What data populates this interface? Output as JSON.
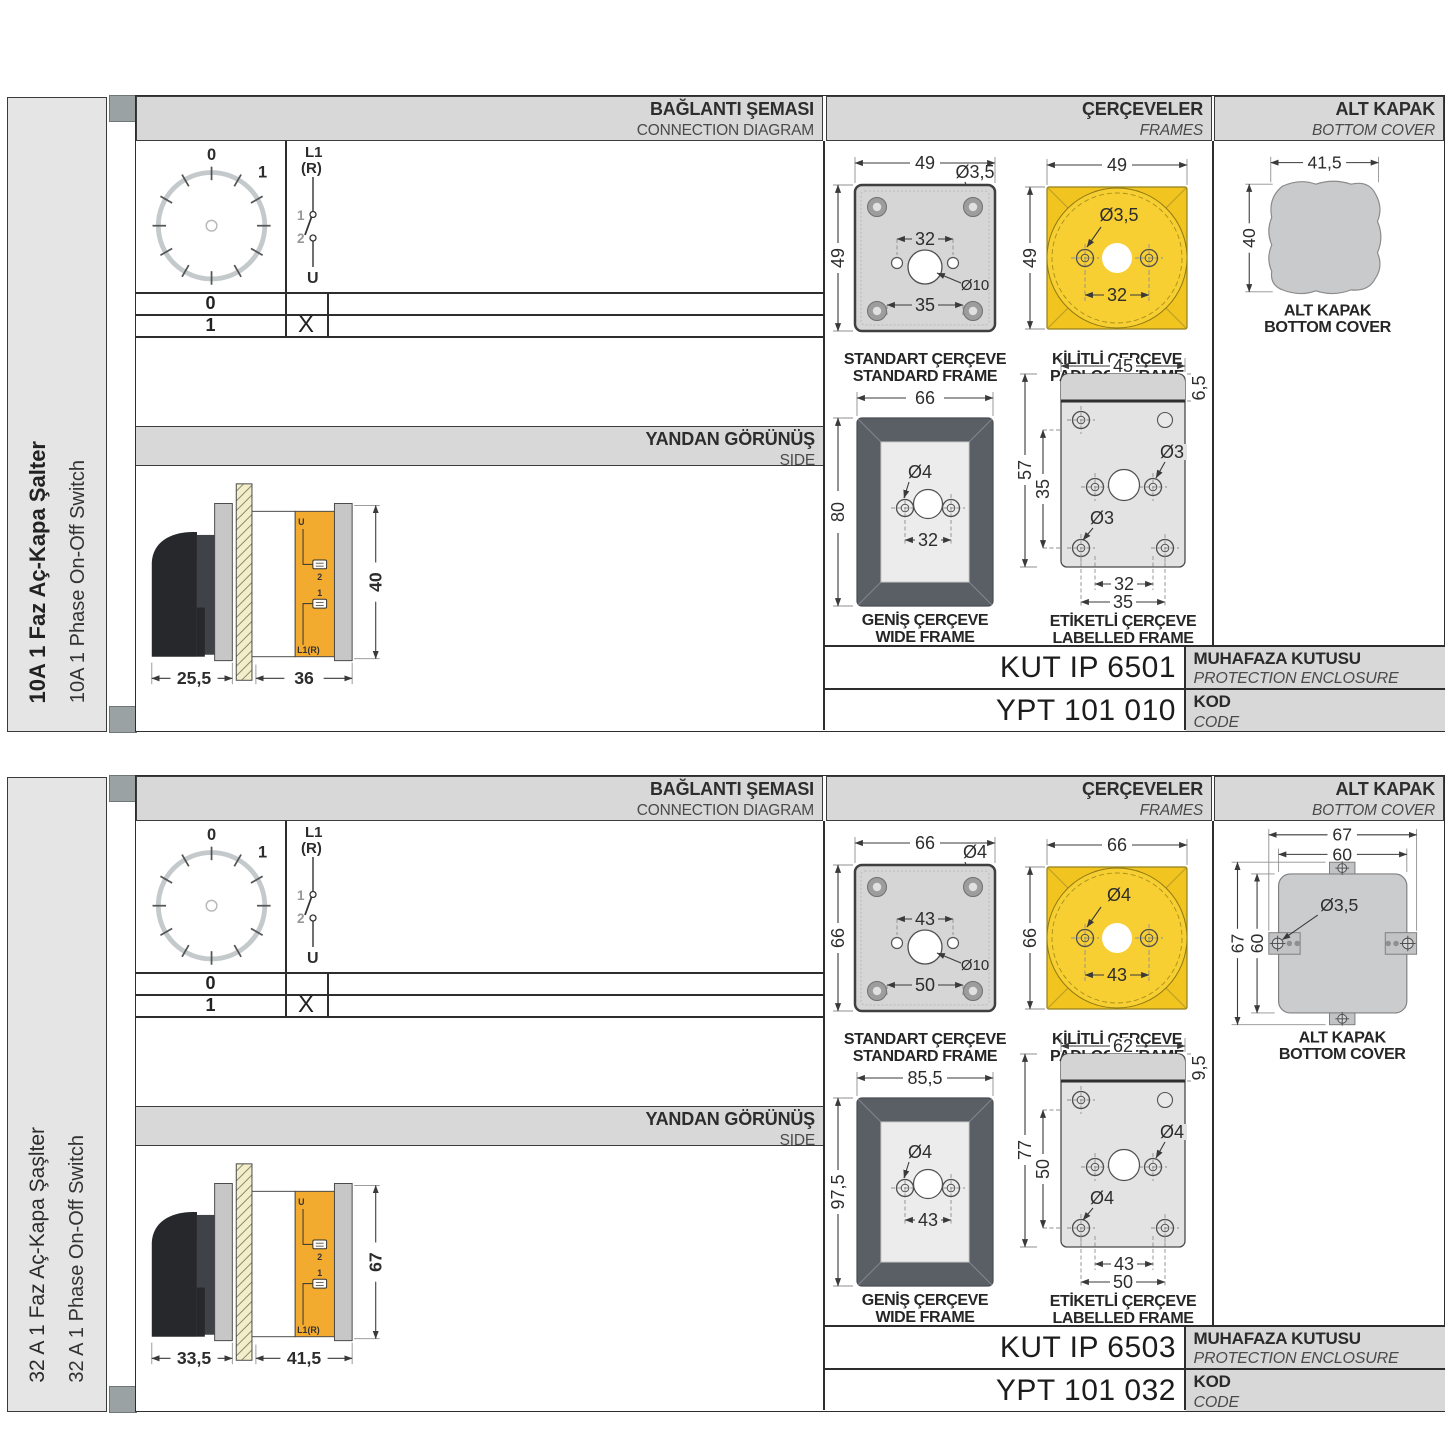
{
  "sections": [
    {
      "side_label_tr": "10A 1 Faz Aç-Kapa Şalter",
      "side_label_en": "10A 1 Phase On-Off Switch",
      "headers": {
        "connection_tr": "BAĞLANTI ŞEMASI",
        "connection_en": "CONNECTION DIAGRAM",
        "frames_tr": "ÇERÇEVELER",
        "frames_en": "FRAMES",
        "cover_tr": "ALT KAPAK",
        "cover_en": "BOTTOM COVER",
        "side_tr": "YANDAN GÖRÜNÜŞ",
        "side_en": "SIDE"
      },
      "connection": {
        "pos_top": "0",
        "pos_right": "1",
        "pole_top_1": "L1",
        "pole_top_2": "(R)",
        "contact_upper": "1",
        "contact_lower": "2",
        "pole_bottom": "U",
        "rows": [
          {
            "pos": "0",
            "mark": ""
          },
          {
            "pos": "1",
            "mark": "X"
          }
        ]
      },
      "side_view": {
        "dim_front": "25,5",
        "dim_body": "36",
        "dim_height": "40",
        "label_u": "U",
        "label_t2": "2",
        "label_t1": "1",
        "label_l1r": "L1(R)"
      },
      "frames": {
        "standard": {
          "title_tr": "STANDART ÇERÇEVE",
          "title_en": "STANDARD FRAME",
          "dim_width": "49",
          "dim_height": "49",
          "dim_hole": "Ø3,5",
          "dim_span_inner": "32",
          "dim_center": "Ø10",
          "dim_span_outer": "35"
        },
        "padlock": {
          "title_tr": "KİLİTLİ ÇERÇEVE",
          "title_en": "PADLOCK FRAME",
          "dim_width": "49",
          "dim_height": "49",
          "dim_hole": "Ø3,5",
          "dim_span": "32"
        },
        "wide": {
          "title_tr": "GENİŞ ÇERÇEVE",
          "title_en": "WIDE FRAME",
          "dim_width": "66",
          "dim_height": "80",
          "dim_hole": "Ø4",
          "dim_span": "32"
        },
        "labelled": {
          "title_tr": "ETİKETLİ ÇERÇEVE",
          "title_en": "LABELLED FRAME",
          "dim_width": "45",
          "dim_strip": "6,5",
          "dim_height": "57",
          "dim_height_inner": "35",
          "dim_hole_right": "Ø3",
          "dim_hole_left": "Ø3",
          "dim_span_inner": "32",
          "dim_span_outer": "35"
        }
      },
      "cover": {
        "title_tr": "ALT KAPAK",
        "title_en": "BOTTOM COVER",
        "dim_width": "41,5",
        "dim_height": "40"
      },
      "codes": {
        "enclosure_code": "KUT IP 6501",
        "enclosure_tr": "MUHAFAZA KUTUSU",
        "enclosure_en": "PROTECTION ENCLOSURE",
        "product_code": "YPT 101 010",
        "code_tr": "KOD",
        "code_en": "CODE"
      }
    },
    {
      "side_label_tr": "32 A 1 Faz Aç-Kapa Şaşlter",
      "side_label_en": "32 A 1 Phase On-Off Switch",
      "headers": {
        "connection_tr": "BAĞLANTI ŞEMASI",
        "connection_en": "CONNECTION DIAGRAM",
        "frames_tr": "ÇERÇEVELER",
        "frames_en": "FRAMES",
        "cover_tr": "ALT KAPAK",
        "cover_en": "BOTTOM COVER",
        "side_tr": "YANDAN GÖRÜNÜŞ",
        "side_en": "SIDE"
      },
      "connection": {
        "pos_top": "0",
        "pos_right": "1",
        "pole_top_1": "L1",
        "pole_top_2": "(R)",
        "contact_upper": "1",
        "contact_lower": "2",
        "pole_bottom": "U",
        "rows": [
          {
            "pos": "0",
            "mark": ""
          },
          {
            "pos": "1",
            "mark": "X"
          }
        ]
      },
      "side_view": {
        "dim_front": "33,5",
        "dim_body": "41,5",
        "dim_height": "67",
        "label_u": "U",
        "label_t2": "2",
        "label_t1": "1",
        "label_l1r": "L1(R)"
      },
      "frames": {
        "standard": {
          "title_tr": "STANDART ÇERÇEVE",
          "title_en": "STANDARD FRAME",
          "dim_width": "66",
          "dim_height": "66",
          "dim_hole": "Ø4",
          "dim_span_inner": "43",
          "dim_center": "Ø10",
          "dim_span_outer": "50"
        },
        "padlock": {
          "title_tr": "KİLİTLİ ÇERÇEVE",
          "title_en": "PADLOCK FRAME",
          "dim_width": "66",
          "dim_height": "66",
          "dim_hole": "Ø4",
          "dim_span": "43"
        },
        "wide": {
          "title_tr": "GENİŞ ÇERÇEVE",
          "title_en": "WIDE FRAME",
          "dim_width": "85,5",
          "dim_height": "97,5",
          "dim_hole": "Ø4",
          "dim_span": "43"
        },
        "labelled": {
          "title_tr": "ETİKETLİ ÇERÇEVE",
          "title_en": "LABELLED FRAME",
          "dim_width": "62",
          "dim_strip": "9,5",
          "dim_height": "77",
          "dim_height_inner": "50",
          "dim_hole_right": "Ø4",
          "dim_hole_left": "Ø4",
          "dim_span_inner": "43",
          "dim_span_outer": "50"
        }
      },
      "cover": {
        "title_tr": "ALT KAPAK",
        "title_en": "BOTTOM COVER",
        "dim_w_outer": "67",
        "dim_w_inner": "60",
        "dim_h_outer": "67",
        "dim_h_inner": "60",
        "dim_hole": "Ø3,5"
      },
      "codes": {
        "enclosure_code": "KUT IP 6503",
        "enclosure_tr": "MUHAFAZA KUTUSU",
        "enclosure_en": "PROTECTION ENCLOSURE",
        "product_code": "YPT 101 032",
        "code_tr": "KOD",
        "code_en": "CODE"
      }
    }
  ]
}
